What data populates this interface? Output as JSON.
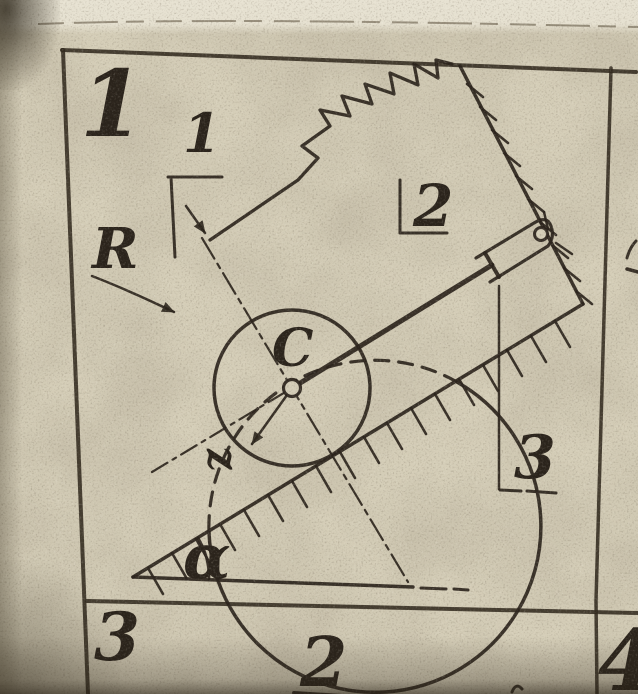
{
  "grid_cells": {
    "top_left_number": "1",
    "bottom_left_number": "3",
    "bottom_column_number": "2",
    "bottom_right_number": "4"
  },
  "labels": {
    "spring": "1",
    "support": "2",
    "damper": "3",
    "outer_radius": "R",
    "center": "C",
    "inner_radius": "z",
    "angle": "α"
  },
  "colors": {
    "paper": "#d5ceb8",
    "paper_light": "#e5e0cf",
    "ink": "#2a231b"
  }
}
